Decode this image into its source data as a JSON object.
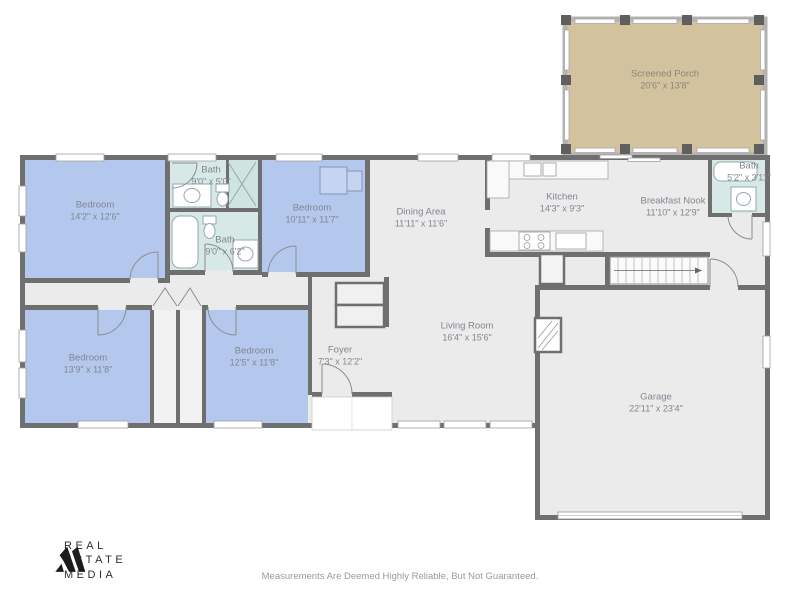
{
  "footer": {
    "disclaimer": "Measurements Are Deemed Highly Reliable, But Not Guaranteed."
  },
  "brand": {
    "line1": "REAL",
    "line2": "ESTATE",
    "line3": "MEDIA"
  },
  "colors": {
    "bedroom_fill": "#b4c8ee",
    "bath_fill": "#d7e9e6",
    "shower_fill": "#cfe4e1",
    "porch_fill": "#d3c29e",
    "floor_fill": "#ebebeb",
    "closet_fill": "#f2f2f2",
    "wall": "#6f6f6f",
    "label_text": "#81868f",
    "logo_black": "#1c1c1c"
  },
  "rooms": [
    {
      "id": "screened-porch",
      "name": "Screened Porch",
      "dims": "20'6\" x 13'8\""
    },
    {
      "id": "bedroom-1",
      "name": "Bedroom",
      "dims": "14'2\" x 12'6\""
    },
    {
      "id": "bath-1",
      "name": "Bath",
      "dims": "9'0\" x 5'0\""
    },
    {
      "id": "bedroom-2",
      "name": "Bedroom",
      "dims": "10'11\" x 11'7\""
    },
    {
      "id": "bath-2",
      "name": "Bath",
      "dims": "9'0\" x 6'2\""
    },
    {
      "id": "dining-area",
      "name": "Dining Area",
      "dims": "11'11\" x 11'6\""
    },
    {
      "id": "kitchen",
      "name": "Kitchen",
      "dims": "14'3\" x 9'3\""
    },
    {
      "id": "breakfast-nook",
      "name": "Breakfast Nook",
      "dims": "11'10\" x 12'9\""
    },
    {
      "id": "bath-3",
      "name": "Bath",
      "dims": "5'2\" x 3'11\""
    },
    {
      "id": "foyer",
      "name": "Foyer",
      "dims": "7'3\" x 12'2\""
    },
    {
      "id": "living-room",
      "name": "Living Room",
      "dims": "16'4\" x 15'6\""
    },
    {
      "id": "bedroom-3",
      "name": "Bedroom",
      "dims": "13'9\" x 11'8\""
    },
    {
      "id": "bedroom-4",
      "name": "Bedroom",
      "dims": "12'5\" x 11'8\""
    },
    {
      "id": "garage",
      "name": "Garage",
      "dims": "22'11\" x 23'4\""
    }
  ]
}
